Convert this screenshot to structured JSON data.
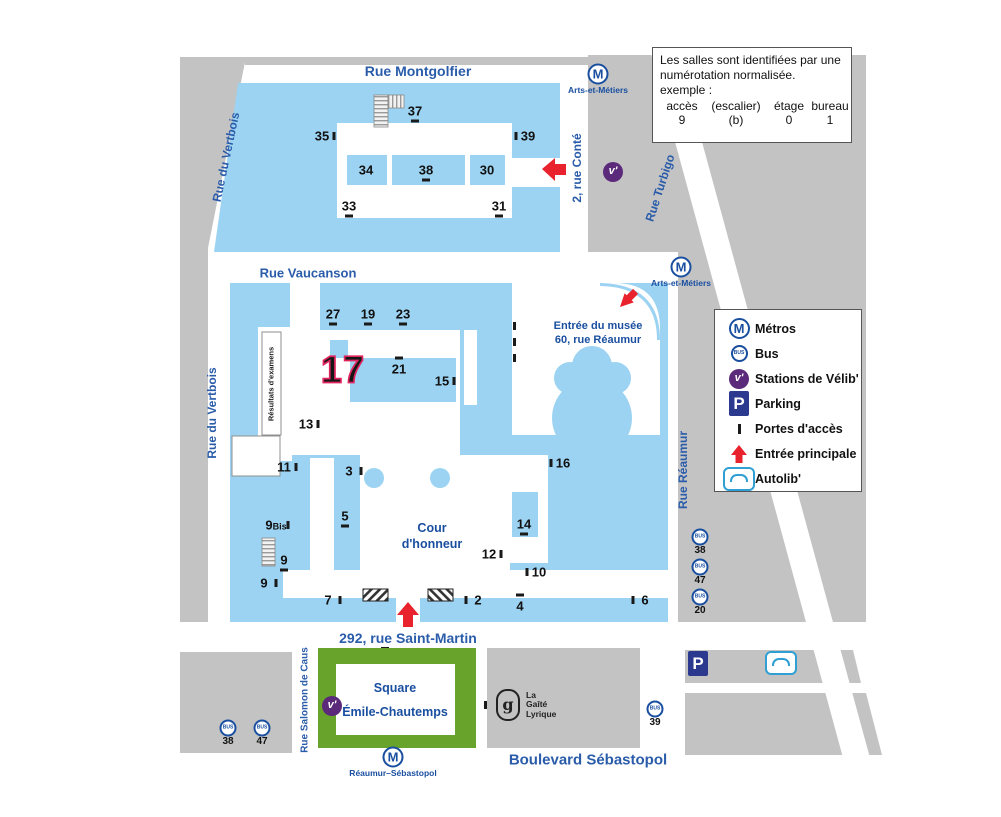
{
  "note_box": {
    "line1": "Les salles sont identifiées par une numérotation normalisée.",
    "line2": "exemple :",
    "columns": [
      "accès",
      "(escalier)",
      "étage",
      "bureau"
    ],
    "values": [
      "9",
      "(b)",
      "0",
      "1"
    ]
  },
  "legend": {
    "items": [
      {
        "icon": "metro",
        "label": "Métros"
      },
      {
        "icon": "bus",
        "label": "Bus"
      },
      {
        "icon": "velib",
        "label": "Stations de Vélib'"
      },
      {
        "icon": "parking",
        "label": "Parking"
      },
      {
        "icon": "porte",
        "label": "Portes d'accès"
      },
      {
        "icon": "arrow",
        "label": "Entrée principale"
      },
      {
        "icon": "autolib",
        "label": "Autolib'"
      }
    ]
  },
  "icons": {
    "metro_glyph": "M",
    "bus_glyph": "BUS",
    "velib_glyph": "v'",
    "parking_glyph": "P"
  },
  "streets": [
    {
      "id": "rue-montgolfier",
      "label": "Rue Montgolfier",
      "x": 418,
      "y": 71,
      "rotate": 0,
      "size": 14
    },
    {
      "id": "rue-du-vertbois-nord",
      "label": "Rue du Vertbois",
      "x": 226,
      "y": 157,
      "rotate": -78,
      "size": 12
    },
    {
      "id": "rue-du-vertbois-sud",
      "label": "Rue du Vertbois",
      "x": 212,
      "y": 413,
      "rotate": -90,
      "size": 12
    },
    {
      "id": "rue-vaucanson",
      "label": "Rue Vaucanson",
      "x": 308,
      "y": 273,
      "rotate": 0,
      "size": 13
    },
    {
      "id": "rue-conte",
      "label": "2, rue Conté",
      "x": 577,
      "y": 168,
      "rotate": -90,
      "size": 12
    },
    {
      "id": "rue-turbigo",
      "label": "Rue Turbigo",
      "x": 660,
      "y": 188,
      "rotate": -72,
      "size": 12
    },
    {
      "id": "rue-reaumur",
      "label": "Rue Réaumur",
      "x": 683,
      "y": 470,
      "rotate": -90,
      "size": 12
    },
    {
      "id": "rue-saint-martin",
      "label": "292, rue Saint-Martin",
      "x": 408,
      "y": 638,
      "rotate": 0,
      "size": 14
    },
    {
      "id": "rue-salomon-de-caus",
      "label": "Rue Salomon de Caus",
      "x": 305,
      "y": 700,
      "rotate": -90,
      "size": 10
    },
    {
      "id": "boulevard-sebastopol",
      "label": "Boulevard Sébastopol",
      "x": 588,
      "y": 760,
      "rotate": 0,
      "size": 15
    }
  ],
  "metro_stations": [
    {
      "name": "Arts-et-Métiers",
      "x": 598,
      "y": 74
    },
    {
      "name": "Arts-et-Métiers",
      "x": 681,
      "y": 267
    },
    {
      "name": "Réaumur–Sébastopol",
      "x": 393,
      "y": 757
    }
  ],
  "bus_stops": [
    {
      "line": "38",
      "x": 700,
      "y": 537
    },
    {
      "line": "47",
      "x": 700,
      "y": 567
    },
    {
      "line": "20",
      "x": 700,
      "y": 597
    },
    {
      "line": "38",
      "x": 228,
      "y": 728
    },
    {
      "line": "47",
      "x": 262,
      "y": 728
    },
    {
      "line": "39",
      "x": 655,
      "y": 709
    }
  ],
  "velib_stations": [
    {
      "x": 613,
      "y": 172
    },
    {
      "x": 332,
      "y": 706
    }
  ],
  "access_points": [
    {
      "n": "37",
      "x": 415,
      "y": 111,
      "tick": "below"
    },
    {
      "n": "35",
      "x": 322,
      "y": 136,
      "tick": "right"
    },
    {
      "n": "39",
      "x": 528,
      "y": 136,
      "tick": "left"
    },
    {
      "n": "34",
      "x": 366,
      "y": 170,
      "tick": "none"
    },
    {
      "n": "38",
      "x": 426,
      "y": 170,
      "tick": "below"
    },
    {
      "n": "30",
      "x": 487,
      "y": 170,
      "tick": "none"
    },
    {
      "n": "33",
      "x": 349,
      "y": 206,
      "tick": "below"
    },
    {
      "n": "31",
      "x": 499,
      "y": 206,
      "tick": "below"
    },
    {
      "n": "27",
      "x": 333,
      "y": 314,
      "tick": "below"
    },
    {
      "n": "19",
      "x": 368,
      "y": 314,
      "tick": "below"
    },
    {
      "n": "23",
      "x": 403,
      "y": 314,
      "tick": "below"
    },
    {
      "n": "21",
      "x": 399,
      "y": 369,
      "tick": "above"
    },
    {
      "n": "15",
      "x": 442,
      "y": 381,
      "tick": "right"
    },
    {
      "n": "13",
      "x": 306,
      "y": 424,
      "tick": "right"
    },
    {
      "n": "11",
      "x": 284,
      "y": 467,
      "tick": "right"
    },
    {
      "n": "3",
      "x": 349,
      "y": 471,
      "tick": "right"
    },
    {
      "n": "5",
      "x": 345,
      "y": 516,
      "tick": "below"
    },
    {
      "n": "9",
      "small": "Bis",
      "x": 276,
      "y": 525,
      "tick": "right"
    },
    {
      "n": "9",
      "x": 284,
      "y": 560,
      "tick": "below"
    },
    {
      "n": "9",
      "x": 264,
      "y": 583,
      "tick": "right"
    },
    {
      "n": "7",
      "x": 328,
      "y": 600,
      "tick": "right"
    },
    {
      "n": "2",
      "x": 478,
      "y": 600,
      "tick": "left"
    },
    {
      "n": "4",
      "x": 520,
      "y": 606,
      "tick": "above"
    },
    {
      "n": "10",
      "x": 539,
      "y": 572,
      "tick": "left"
    },
    {
      "n": "12",
      "x": 489,
      "y": 554,
      "tick": "right"
    },
    {
      "n": "14",
      "x": 524,
      "y": 524,
      "tick": "below"
    },
    {
      "n": "16",
      "x": 563,
      "y": 463,
      "tick": "left"
    },
    {
      "n": "6",
      "x": 645,
      "y": 600,
      "tick": "left"
    }
  ],
  "highlight": {
    "n": "17"
  },
  "pois": {
    "musee": {
      "line1": "Entrée du musée",
      "line2": "60, rue Réaumur"
    },
    "cour": {
      "line1": "Cour",
      "line2": "d'honneur"
    },
    "square": {
      "line1": "Square",
      "line2": "Émile-Chautemps"
    },
    "resultats": {
      "label": "Résultats d'examens"
    },
    "gaite": {
      "glyph": "g",
      "line1": "La",
      "line2": "Gaîté",
      "line3": "Lyrique"
    }
  },
  "colors": {
    "campus_blue": "#9cd3f2",
    "block_gray": "#c3c3c3",
    "street_text_blue": "#2a5caa",
    "dark_blue": "#1a4fa0",
    "entrance_red": "#e8232e",
    "velib_purple": "#5c2a7a",
    "parking_navy": "#2b3a8f",
    "square_green": "#68a32b",
    "highlight_pink": "#e0245e",
    "autolib_blue": "#2f9fd4"
  }
}
